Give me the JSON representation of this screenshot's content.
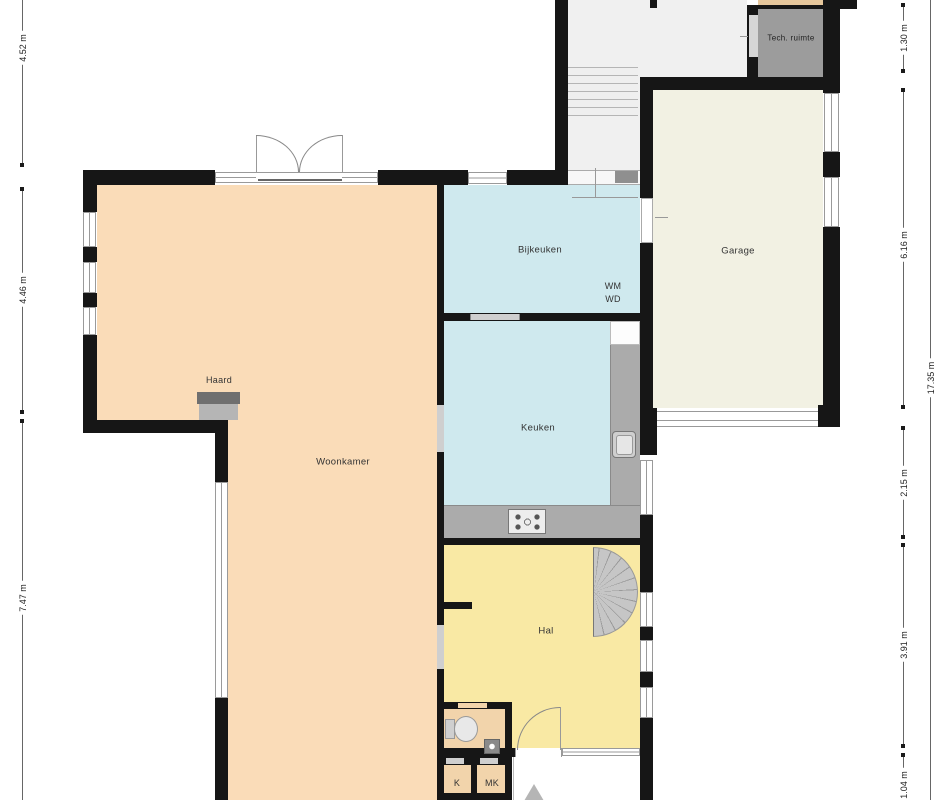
{
  "plan": {
    "type": "floorplan",
    "rooms": {
      "woonkamer": "Woonkamer",
      "keuken": "Keuken",
      "bijkeuken": "Bijkeuken",
      "garage": "Garage",
      "hal": "Hal",
      "tech_ruimte": "Tech. ruimte",
      "haard": "Haard",
      "wm": "WM",
      "wd": "WD",
      "k": "K",
      "mk": "MK"
    },
    "dimensions": {
      "left": [
        {
          "label": "4.52 m"
        },
        {
          "label": "4.46 m"
        },
        {
          "label": "7.47 m"
        }
      ],
      "right": [
        {
          "label": "1.30 m"
        },
        {
          "label": "6.16 m"
        },
        {
          "label": "2.15 m"
        },
        {
          "label": "3.91 m"
        },
        {
          "label": "1.04 m"
        }
      ],
      "total_right": "17.35 m"
    },
    "colors": {
      "wall": "#161616",
      "woonkamer": "#fadcb8",
      "kitchen_blue": "#cfe9ee",
      "hal_yellow": "#f9e9a4",
      "garage_cream": "#f2f1e3",
      "tech_gray": "#9c9c9c",
      "closet_tan": "#f2d4ab",
      "counter_gray": "#ababab"
    }
  }
}
